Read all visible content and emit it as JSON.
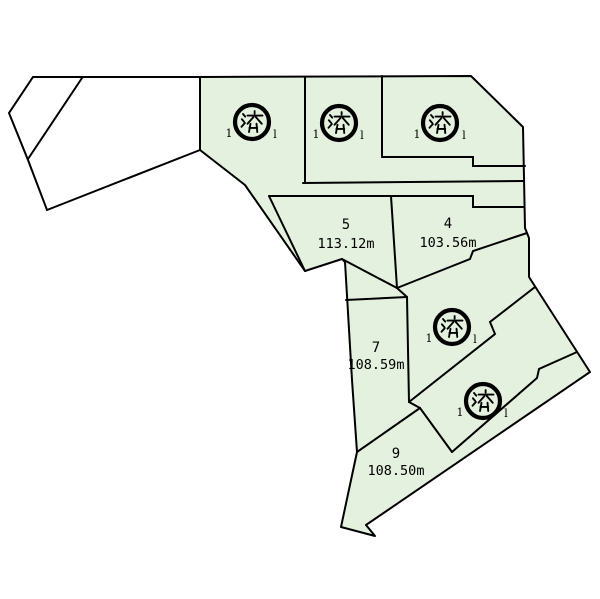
{
  "page": {
    "background": "#ffffff"
  },
  "map": {
    "kind": "land-subdivision-lot-map",
    "sold_stamp_char": "済",
    "colors": {
      "lot_fill": "#e4f1de",
      "boundary_line": "#000000",
      "unsold_parcel_fill": "#ffffff"
    },
    "plots": [
      {
        "no": "1",
        "status": "sold",
        "visible_fragments": [
          "1",
          "l"
        ]
      },
      {
        "no": "2",
        "status": "sold",
        "visible_fragments": [
          "1",
          "l"
        ]
      },
      {
        "no": "3",
        "status": "sold",
        "visible_fragments": [
          "1",
          "l"
        ]
      },
      {
        "no": "4",
        "status": "available",
        "area_label": "103.56m"
      },
      {
        "no": "5",
        "status": "available",
        "area_label": "113.12m"
      },
      {
        "no": "6",
        "status": "sold",
        "visible_fragments": [
          "1",
          "l"
        ]
      },
      {
        "no": "7",
        "status": "available",
        "area_label": "108.59m"
      },
      {
        "no": "8",
        "status": "sold",
        "visible_fragments": [
          "1",
          "l"
        ]
      },
      {
        "no": "9",
        "status": "available",
        "area_label": "108.50m"
      }
    ]
  }
}
